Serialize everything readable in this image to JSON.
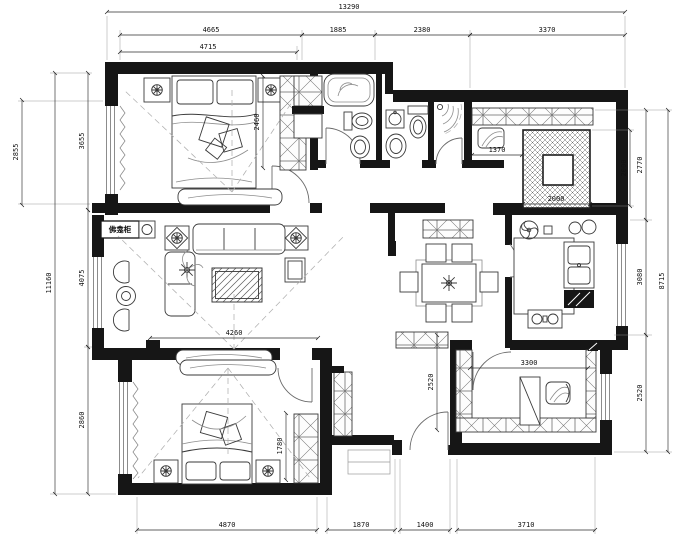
{
  "plan": {
    "labels": {
      "shrine_cabinet": "佛龛柜"
    },
    "dims": {
      "top_overall": "13290",
      "top_1": "4665",
      "top_2": "1885",
      "top_3": "2380",
      "top_4": "3370",
      "top_sub": "4715",
      "left_outer": "2855",
      "left_overall": "11160",
      "left_1": "3655",
      "left_2": "4075",
      "left_3": "2860",
      "right_shaft": "2000",
      "right_1": "2770",
      "right_2": "3080",
      "right_3": "2520",
      "right_overall": "8715",
      "bottom_1": "4870",
      "bottom_2": "1870",
      "bottom_3": "1400",
      "bottom_4": "3710",
      "in_bed1_depth": "2460",
      "in_closet_width": "1370",
      "in_shaft_width": "2000",
      "in_living_width": "4260",
      "in_bed2_depth": "1780",
      "in_study_width": "3300",
      "in_corridor_depth": "2520"
    },
    "colors": {
      "line": "#1a1a1a",
      "wall": "#161616",
      "background": "#ffffff"
    }
  }
}
